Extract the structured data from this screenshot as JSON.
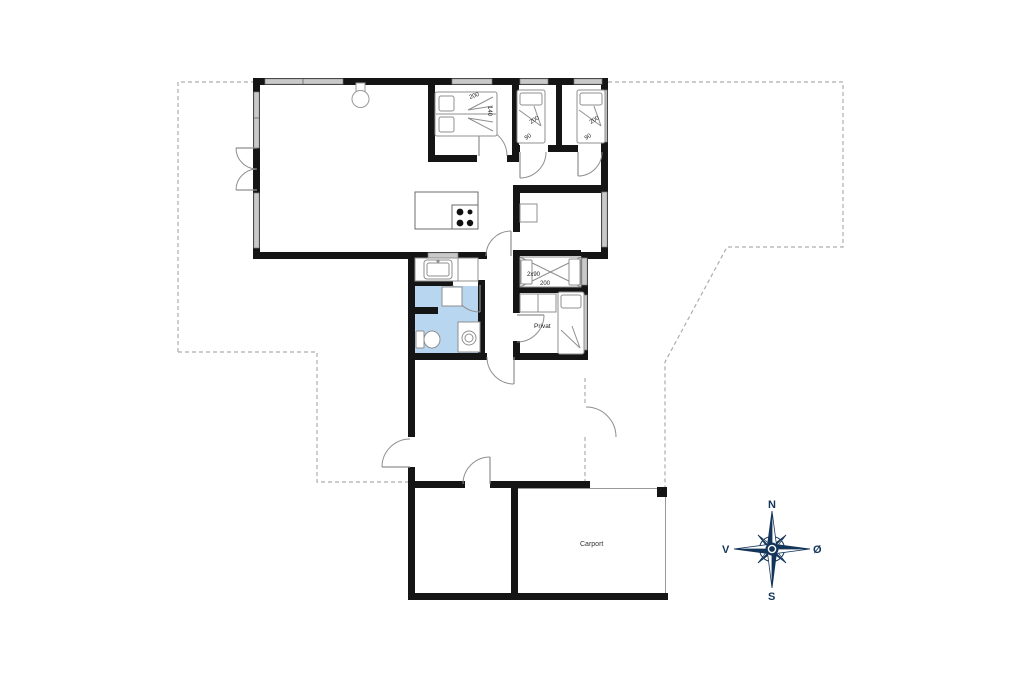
{
  "floorplan": {
    "double_bedroom": {
      "bed_length": "200",
      "bed_width": "140"
    },
    "single_bedroom_1": {
      "bed_length": "200",
      "bed_width": "90"
    },
    "single_bedroom_2": {
      "bed_length": "200",
      "bed_width": "90"
    },
    "bunk_room": {
      "bed_size": "2x90",
      "bed_length": "200"
    },
    "private_room": {
      "label": "Privat"
    },
    "carport": {
      "label": "Carport"
    },
    "compass": {
      "north": "N",
      "east": "Ø",
      "south": "S",
      "west": "V"
    },
    "colors": {
      "wall": "#151515",
      "window_fill": "#c9c9c9",
      "bathroom_fill": "#b9d6f0",
      "boundary_dash": "#adadad",
      "compass_navy": "#14355a"
    }
  }
}
